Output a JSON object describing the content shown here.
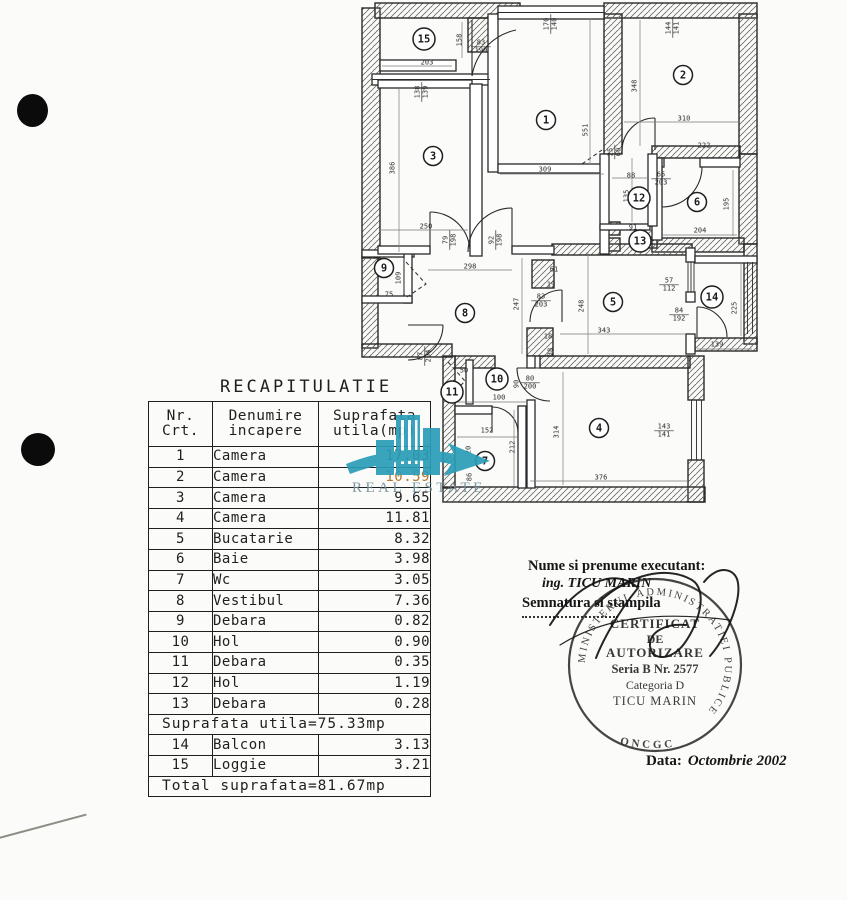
{
  "table": {
    "title": "RECAPITULATIE",
    "headers": {
      "col1a": "Nr.",
      "col1b": "Crt.",
      "col2a": "Denumire",
      "col2b": "incapere",
      "col3a": "Suprafata",
      "col3b": "utila(mp)"
    },
    "rows": [
      {
        "nr": "1",
        "name": "Camera",
        "area": "17.03"
      },
      {
        "nr": "2",
        "name": "Camera",
        "area": "10.59"
      },
      {
        "nr": "3",
        "name": "Camera",
        "area": "9.65"
      },
      {
        "nr": "4",
        "name": "Camera",
        "area": "11.81"
      },
      {
        "nr": "5",
        "name": "Bucatarie",
        "area": "8.32"
      },
      {
        "nr": "6",
        "name": "Baie",
        "area": "3.98"
      },
      {
        "nr": "7",
        "name": "Wc",
        "area": "3.05"
      },
      {
        "nr": "8",
        "name": "Vestibul",
        "area": "7.36"
      },
      {
        "nr": "9",
        "name": "Debara",
        "area": "0.82"
      },
      {
        "nr": "10",
        "name": "Hol",
        "area": "0.90"
      },
      {
        "nr": "11",
        "name": "Debara",
        "area": "0.35"
      },
      {
        "nr": "12",
        "name": "Hol",
        "area": "1.19"
      },
      {
        "nr": "13",
        "name": "Debara",
        "area": "0.28"
      }
    ],
    "subtotal": "Suprafata utila=75.33mp",
    "rows2": [
      {
        "nr": "14",
        "name": "Balcon",
        "area": "3.13"
      },
      {
        "nr": "15",
        "name": "Loggie",
        "area": "3.21"
      }
    ],
    "total": "Total suprafata=81.67mp"
  },
  "stamp": {
    "line1": "Nume si prenume executant:",
    "line2": "ing. TICU MARIN",
    "line3": "Semnatura si stampila",
    "ring_text": "MINISTERUL ADMINISTRATIEI PUBLICE",
    "ring_bottom": "ONCGC",
    "center": [
      "CERTIFICAT",
      "DE",
      "AUTORIZARE",
      "Seria B Nr. 2577",
      "Categoria D",
      "TICU MARIN"
    ],
    "date_label": "Data:",
    "date_value": "Octombrie 2002"
  },
  "watermark": {
    "text": "REAL ESTATE",
    "color": "#2a9db8"
  },
  "floor_plan": {
    "rooms": [
      {
        "n": "15",
        "x": 424,
        "y": 39
      },
      {
        "n": "3",
        "x": 433,
        "y": 156
      },
      {
        "n": "1",
        "x": 546,
        "y": 120
      },
      {
        "n": "2",
        "x": 683,
        "y": 75
      },
      {
        "n": "12",
        "x": 639,
        "y": 198
      },
      {
        "n": "6",
        "x": 697,
        "y": 202
      },
      {
        "n": "13",
        "x": 640,
        "y": 241
      },
      {
        "n": "9",
        "x": 384,
        "y": 268
      },
      {
        "n": "8",
        "x": 465,
        "y": 313
      },
      {
        "n": "5",
        "x": 613,
        "y": 302
      },
      {
        "n": "14",
        "x": 712,
        "y": 297
      },
      {
        "n": "10",
        "x": 497,
        "y": 379
      },
      {
        "n": "11",
        "x": 452,
        "y": 392
      },
      {
        "n": "7",
        "x": 485,
        "y": 461
      },
      {
        "n": "4",
        "x": 599,
        "y": 428
      }
    ],
    "labels": [
      {
        "t": "203",
        "x": 427,
        "y": 62
      },
      {
        "t": "158",
        "x": 459,
        "y": 40,
        "r": -90
      },
      {
        "t": "83",
        "b": "199",
        "x": 481,
        "y": 46
      },
      {
        "t": "138",
        "b": "139",
        "x": 421,
        "y": 92,
        "r": -90
      },
      {
        "t": "386",
        "x": 392,
        "y": 168,
        "r": -90
      },
      {
        "t": "250",
        "x": 426,
        "y": 226
      },
      {
        "t": "79",
        "b": "198",
        "x": 449,
        "y": 240,
        "r": -90
      },
      {
        "t": "92",
        "b": "198",
        "x": 495,
        "y": 240,
        "r": -90
      },
      {
        "t": "298",
        "x": 470,
        "y": 266
      },
      {
        "t": "170",
        "b": "140",
        "x": 550,
        "y": 24,
        "r": -90
      },
      {
        "t": "551",
        "x": 585,
        "y": 130,
        "r": -90
      },
      {
        "t": "309",
        "x": 545,
        "y": 169
      },
      {
        "t": "144",
        "b": "141",
        "x": 672,
        "y": 28,
        "r": -90
      },
      {
        "t": "348",
        "x": 634,
        "y": 86,
        "r": -90
      },
      {
        "t": "310",
        "x": 684,
        "y": 118
      },
      {
        "t": "222",
        "x": 704,
        "y": 145
      },
      {
        "t": "25",
        "b": "60",
        "x": 614,
        "y": 152,
        "r": -90
      },
      {
        "t": "88",
        "x": 631,
        "y": 175
      },
      {
        "t": "65",
        "b": "203",
        "x": 661,
        "y": 178
      },
      {
        "t": "135",
        "x": 626,
        "y": 196,
        "r": -90
      },
      {
        "t": "195",
        "x": 726,
        "y": 204,
        "r": -90
      },
      {
        "t": "204",
        "x": 700,
        "y": 230
      },
      {
        "t": "91",
        "x": 633,
        "y": 227
      },
      {
        "t": "109",
        "x": 398,
        "y": 278,
        "r": -90
      },
      {
        "t": "75",
        "x": 389,
        "y": 294
      },
      {
        "t": "247",
        "x": 516,
        "y": 304,
        "r": -90
      },
      {
        "t": "61",
        "x": 554,
        "y": 269
      },
      {
        "t": "19",
        "x": 551,
        "y": 284
      },
      {
        "t": "83",
        "b": "203",
        "x": 541,
        "y": 300
      },
      {
        "t": "18",
        "x": 548,
        "y": 336
      },
      {
        "t": "38",
        "x": 550,
        "y": 352,
        "r": -90
      },
      {
        "t": "248",
        "x": 581,
        "y": 306,
        "r": -90
      },
      {
        "t": "343",
        "x": 604,
        "y": 330
      },
      {
        "t": "57",
        "b": "112",
        "x": 669,
        "y": 284
      },
      {
        "t": "84",
        "b": "192",
        "x": 679,
        "y": 314
      },
      {
        "t": "139",
        "x": 717,
        "y": 344
      },
      {
        "t": "225",
        "x": 734,
        "y": 308,
        "r": -90
      },
      {
        "t": "87",
        "b": "204",
        "x": 424,
        "y": 356,
        "r": -90
      },
      {
        "t": "50",
        "x": 464,
        "y": 370
      },
      {
        "t": "90",
        "x": 516,
        "y": 384,
        "r": -90
      },
      {
        "t": "80",
        "b": "200",
        "x": 530,
        "y": 382
      },
      {
        "t": "100",
        "x": 499,
        "y": 397
      },
      {
        "t": "152",
        "x": 487,
        "y": 430
      },
      {
        "t": "212",
        "x": 512,
        "y": 447,
        "r": -90
      },
      {
        "t": "20",
        "x": 468,
        "y": 450,
        "r": -90
      },
      {
        "t": "86",
        "x": 469,
        "y": 477,
        "r": -90
      },
      {
        "t": "314",
        "x": 556,
        "y": 432,
        "r": -90
      },
      {
        "t": "376",
        "x": 601,
        "y": 477
      },
      {
        "t": "143",
        "b": "141",
        "x": 664,
        "y": 430
      }
    ]
  }
}
